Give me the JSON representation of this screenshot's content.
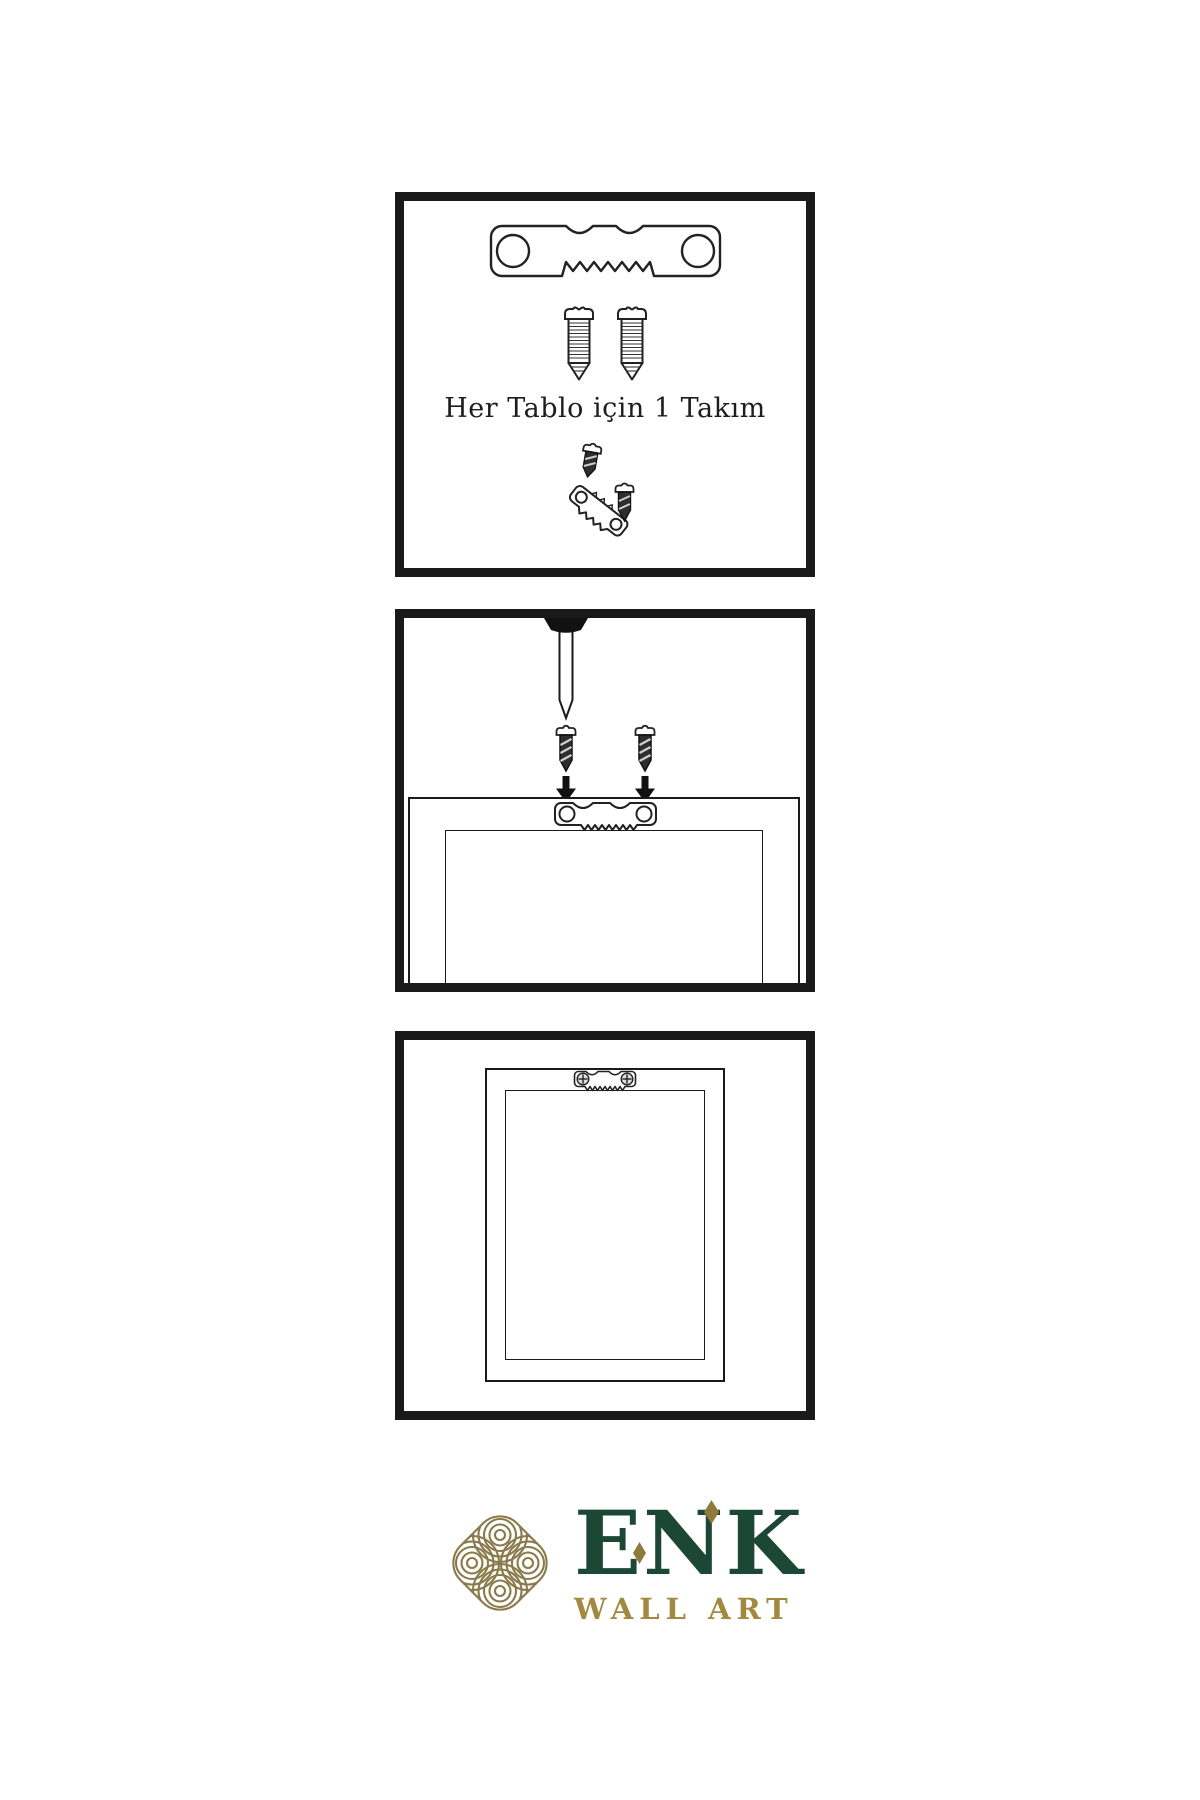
{
  "page": {
    "background": "#ffffff",
    "line_color": "#1a1a1a"
  },
  "steps": {
    "kit": {
      "caption": "Her Tablo için 1 Takım"
    },
    "nailing": {
      "description_visible_text": ""
    },
    "hung": {
      "description_visible_text": ""
    }
  },
  "brand": {
    "name": "ENK",
    "tagline": "WALL ART",
    "colors": {
      "name_green": "#1c4734",
      "tagline_gold": "#a3893f",
      "icon_gold": "#8a7a4a",
      "diamond_gold": "#8f7a3e"
    }
  },
  "icons": {
    "sawtooth_hanger": "sawtooth-hanger-icon",
    "screw": "screw-icon",
    "dark_screw": "mounting-screw-icon",
    "wall_nail": "wall-nail-icon",
    "arrow_down": "arrow-down-icon",
    "frame_back": "frame-back-view",
    "logo_knot": "knot-logo-icon"
  }
}
